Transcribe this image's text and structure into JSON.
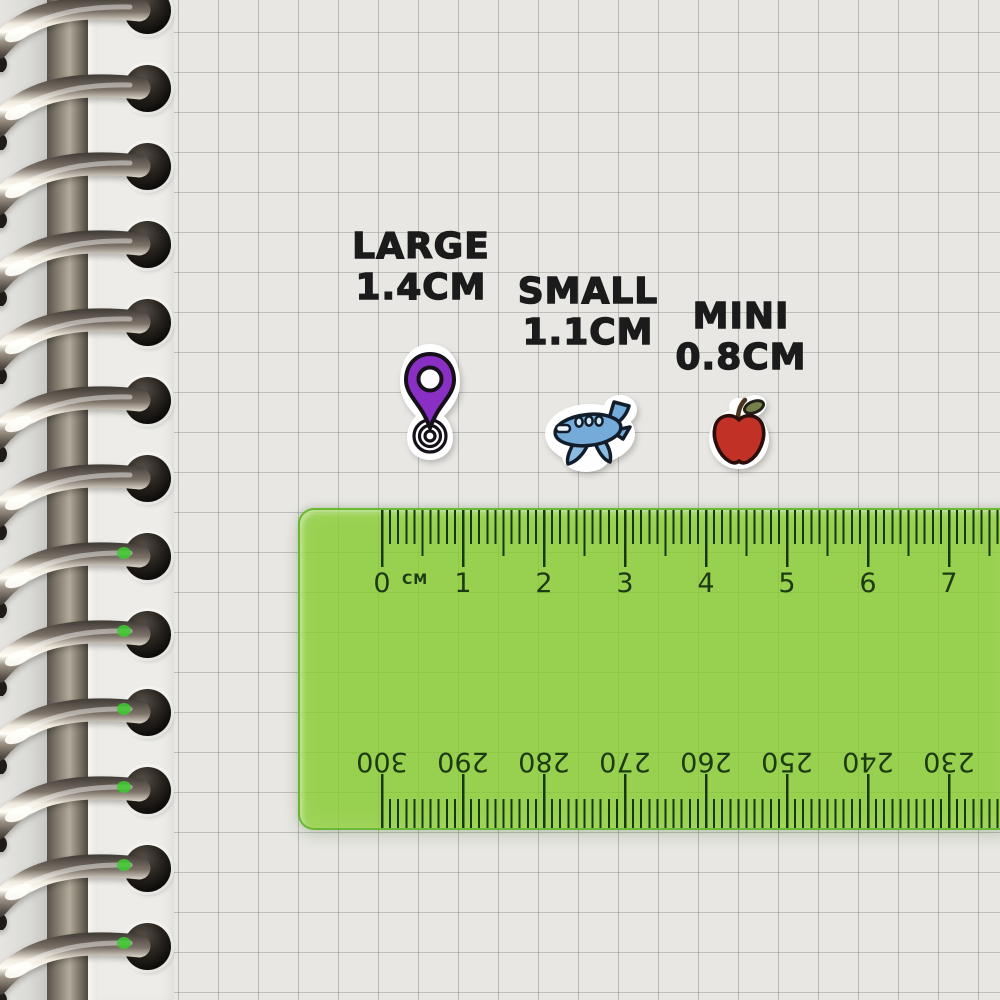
{
  "size_labels": [
    {
      "id": "large",
      "name": "LARGE",
      "size": "1.4CM"
    },
    {
      "id": "small",
      "name": "SMALL",
      "size": "1.1CM"
    },
    {
      "id": "mini",
      "name": "MINI",
      "size": "0.8CM"
    }
  ],
  "stickers": [
    {
      "id": "location-pin",
      "description": "purple map location pin sticker with ripple base",
      "color": "#8a2fc4"
    },
    {
      "id": "airplane",
      "description": "blue cartoon airplane sticker",
      "color": "#74abd9"
    },
    {
      "id": "apple",
      "description": "red apple sticker with leaf",
      "color": "#c23126"
    }
  ],
  "ruler": {
    "unit_label": "CM",
    "cm_numbers": [
      "0",
      "1",
      "2",
      "3",
      "4",
      "5",
      "6",
      "7"
    ],
    "mm_numbers": [
      "300",
      "290",
      "280",
      "270",
      "260",
      "250",
      "240",
      "230"
    ],
    "body_color": "#8fd24a",
    "tick_color": "#16380e"
  },
  "paper": {
    "background": "#e8e7e3",
    "grid_line": "#b1b0ac"
  }
}
